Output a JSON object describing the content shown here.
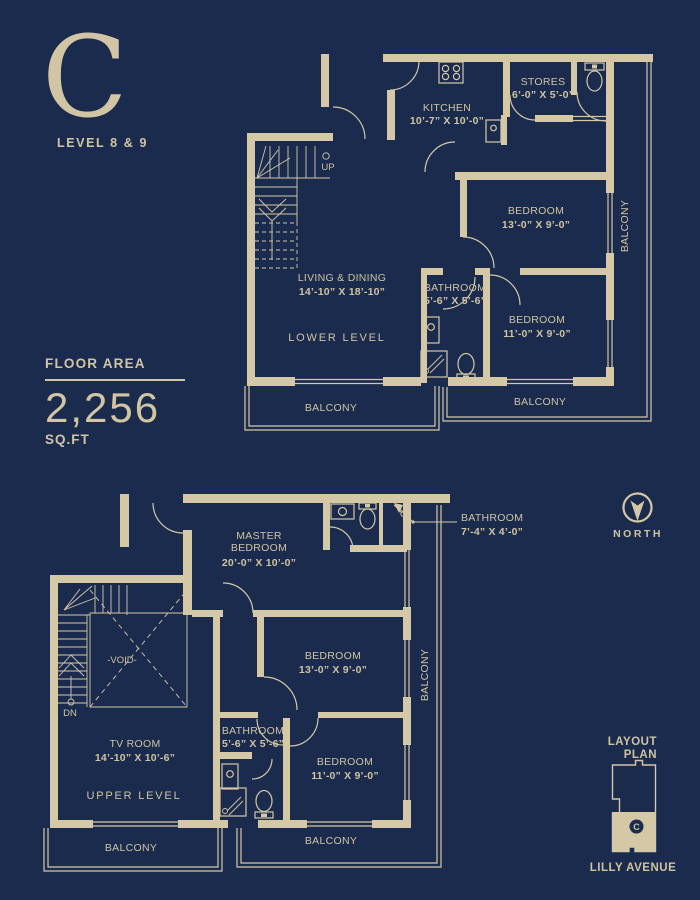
{
  "header": {
    "unit_letter": "C",
    "level": "LEVEL 8 & 9"
  },
  "floor_area": {
    "label": "FLOOR AREA",
    "value": "2,256",
    "units": "SQ.FT"
  },
  "compass": {
    "label": "NORTH"
  },
  "minimap": {
    "line1": "LAYOUT",
    "line2": "PLAN",
    "marker": "C",
    "street": "LILLY AVENUE"
  },
  "colors": {
    "background": "#1a2b4d",
    "line": "#d5c8a6"
  },
  "lower": {
    "level_label": "LOWER LEVEL",
    "stair_label": "UP",
    "kitchen": {
      "name": "KITCHEN",
      "dims": "10’-7” X 10’-0”"
    },
    "stores": {
      "name": "STORES",
      "dims": "6’-0” X 5’-0”"
    },
    "bedroom_a": {
      "name": "BEDROOM",
      "dims": "13’-0” X 9’-0”"
    },
    "bathroom": {
      "name": "BATHROOM",
      "dims": "5’-6” X 5’-6”"
    },
    "bedroom_b": {
      "name": "BEDROOM",
      "dims": "11’-0” X 9’-0”"
    },
    "living": {
      "name": "LIVING & DINING",
      "dims": "14’-10” X 18’-10”"
    },
    "balconies": [
      "BALCONY",
      "BALCONY",
      "BALCONY"
    ]
  },
  "upper": {
    "level_label": "UPPER LEVEL",
    "stair_label": "DN",
    "void_label": "-VOID-",
    "master": {
      "name_line1": "MASTER",
      "name_line2": "BEDROOM",
      "dims": "20’-0” X 10’-0”"
    },
    "bathroom_a": {
      "name": "BATHROOM",
      "dims": "7’-4” X 4’-0”"
    },
    "bedroom_a": {
      "name": "BEDROOM",
      "dims": "13’-0” X 9’-0”"
    },
    "bathroom_b": {
      "name": "BATHROOM",
      "dims": "5’-6” X 5’-6”"
    },
    "bedroom_b": {
      "name": "BEDROOM",
      "dims": "11’-0” X 9’-0”"
    },
    "tv_room": {
      "name": "TV ROOM",
      "dims": "14’-10” X 10’-6”"
    },
    "balconies": [
      "BALCONY",
      "BALCONY",
      "BALCONY"
    ]
  }
}
